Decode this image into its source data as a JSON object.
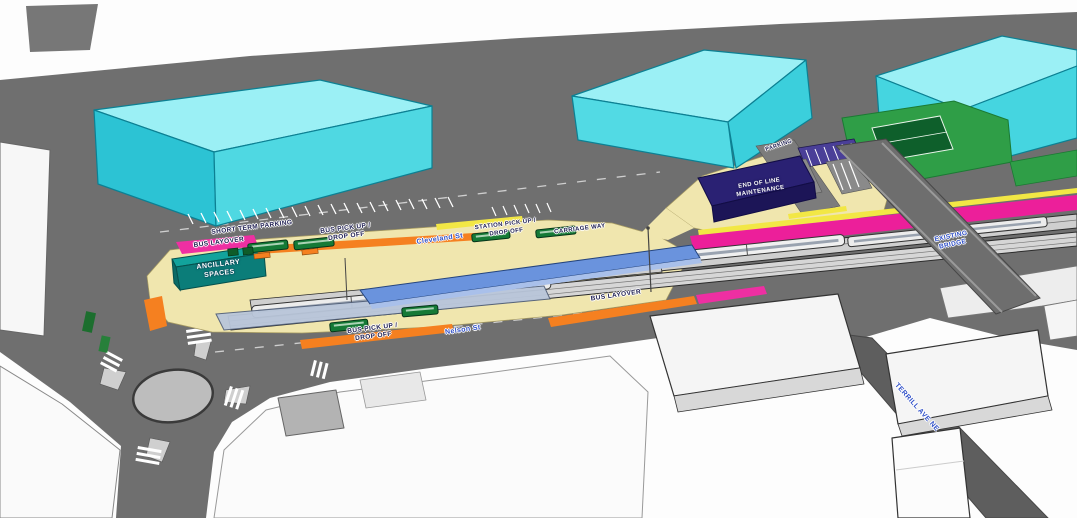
{
  "labels": {
    "bus_layover_west": "BUS LAYOVER",
    "short_term_parking": "SHORT TERM PARKING",
    "bus_pickup_north": "BUS PICK UP /\nDROP OFF",
    "cleveland_st": "Cleveland St",
    "station_pickup": "STATION PICK UP /\nDROP OFF",
    "carriage_way": "CARRIAGE WAY",
    "parking_road": "PARKING",
    "end_of_line_maintenance": "END OF LINE\nMAINTENANCE",
    "ancillary_spaces": "ANCILLARY\nSPACES",
    "bus_layover_east": "BUS LAYOVER",
    "bus_pickup_south": "BUS PICK UP /\nDROP OFF",
    "nelson_st": "Nelson St",
    "existing_bridge": "EXISTING\nBRIDGE",
    "terrill_ave": "TERRILL AVE NE"
  },
  "palette": {
    "glass_building_cyan": "#9bf0f5",
    "plaza_khaki": "#f0e6ae",
    "bus_zone_orange": "#f58020",
    "layover_magenta": "#ee2fa2",
    "curb_yellow": "#f2e745",
    "maintenance_navy": "#2a2173",
    "ancillary_teal": "#0f8f8a",
    "field_green": "#2f9e47",
    "canopy_blue": "#6a93dd",
    "road_gray": "#6f6f6f"
  }
}
